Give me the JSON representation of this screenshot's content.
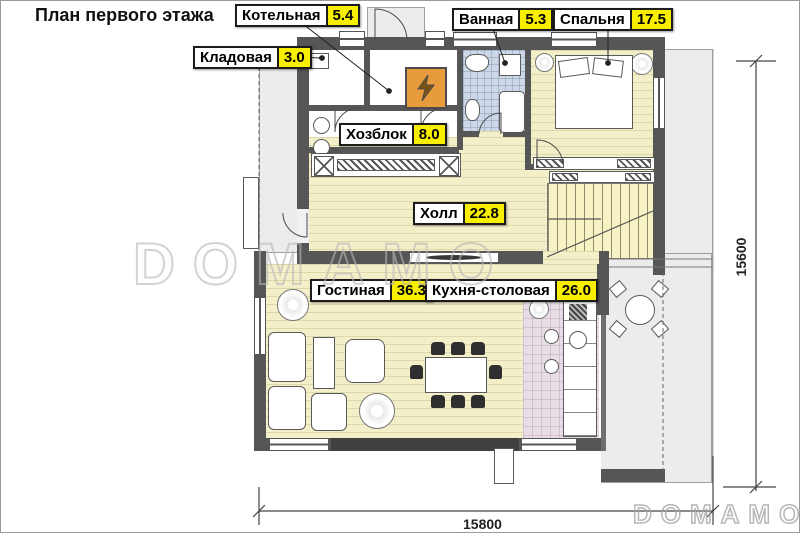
{
  "title": "План первого этажа",
  "rooms": [
    {
      "id": "kotelnaya",
      "name": "Котельная",
      "area": "5.4"
    },
    {
      "id": "vannaya",
      "name": "Ванная",
      "area": "5.3"
    },
    {
      "id": "spalnya",
      "name": "Спальня",
      "area": "17.5"
    },
    {
      "id": "kladovaya",
      "name": "Кладовая",
      "area": "3.0"
    },
    {
      "id": "hozblok",
      "name": "Хозблок",
      "area": "8.0"
    },
    {
      "id": "holl",
      "name": "Холл",
      "area": "22.8"
    },
    {
      "id": "gostinaya",
      "name": "Гостиная",
      "area": "36.3"
    },
    {
      "id": "kuhnya",
      "name": "Кухня-столовая",
      "area": "26.0"
    }
  ],
  "dimensions": {
    "bottom": "15800",
    "right": "15600"
  },
  "watermarks": {
    "center": "DOMAMO",
    "corner": "DOMAMO"
  },
  "icons": {
    "boiler": "lightning-icon"
  },
  "colors": {
    "wall": "#565656",
    "floor_wood": "#f3efc9",
    "floor_tile_green": "#e5e9d6",
    "floor_tile_blue": "#ccd7e7",
    "floor_tile_pink": "#e8dde6",
    "label_highlight": "#f8ee00",
    "boiler_orange": "#e79b3c",
    "outdoor": "#ececec"
  }
}
